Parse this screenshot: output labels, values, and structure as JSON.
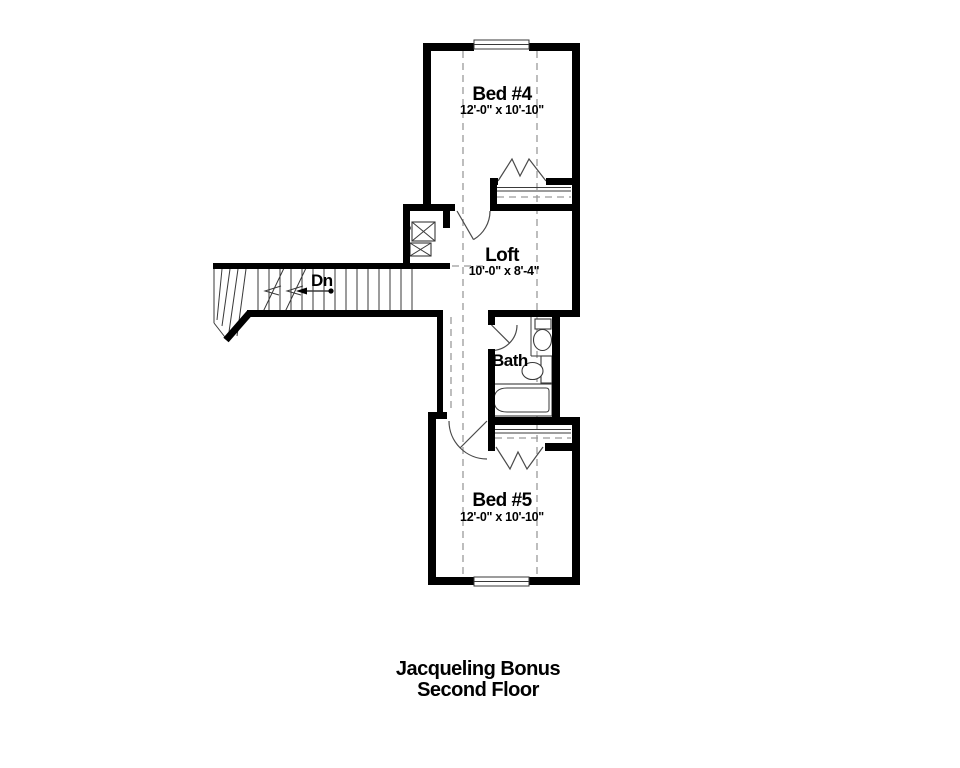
{
  "plan": {
    "rooms": {
      "bed4": {
        "name": "Bed #4",
        "dims": "12'-0\" x 10'-10\""
      },
      "loft": {
        "name": "Loft",
        "dims": "10'-0\" x 8'-4\""
      },
      "bath": {
        "name": "Bath"
      },
      "bed5": {
        "name": "Bed #5",
        "dims": "12'-0\" x 10'-10\""
      }
    },
    "stairs": {
      "label": "Dn"
    },
    "title": {
      "line1": "Jacqueling Bonus",
      "line2": "Second Floor"
    },
    "colors": {
      "wall": "#000000",
      "thin_line": "#3a3a3a",
      "dashed_line": "#9a9a9a",
      "background": "#ffffff"
    }
  }
}
